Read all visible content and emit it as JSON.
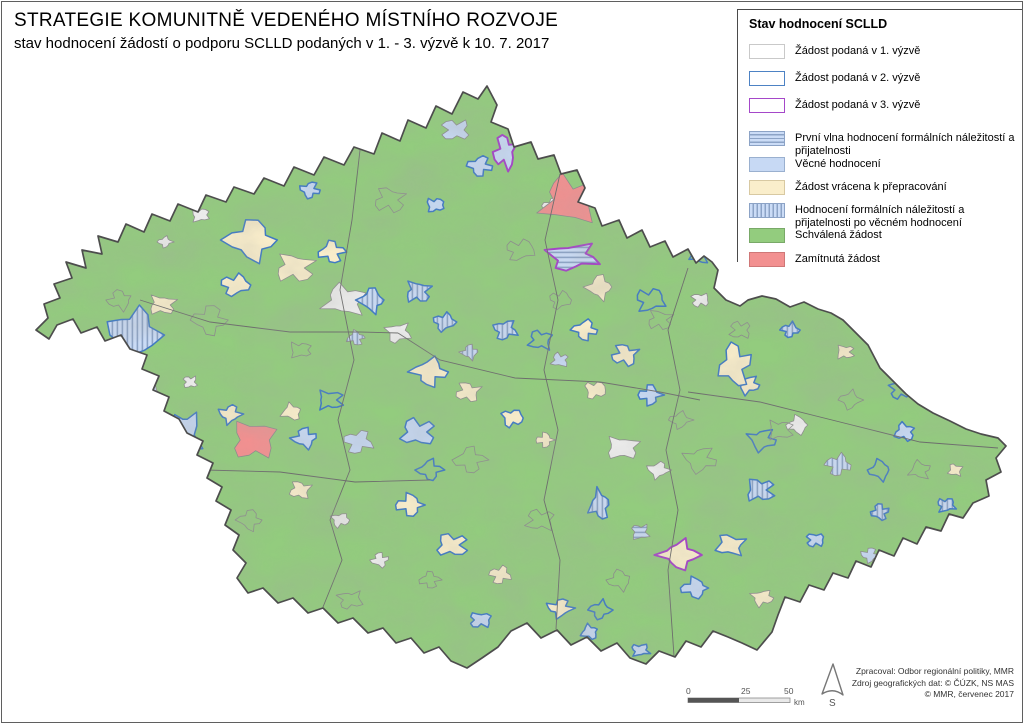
{
  "title": {
    "line1": "STRATEGIE KOMUNITNĚ VEDENÉHO MÍSTNÍHO ROZVOJE",
    "line2": "stav hodnocení žádostí o podporu SCLLD podaných v 1. - 3. výzvě k 10. 7. 2017"
  },
  "legend": {
    "title": "Stav hodnocení SCLLD",
    "items": [
      {
        "swatch": "outline-gray",
        "label": "Žádost podaná v 1. výzvě",
        "top": 34
      },
      {
        "swatch": "outline-blue",
        "label": "Žádost podaná v 2. výzvě",
        "top": 61
      },
      {
        "swatch": "outline-purple",
        "label": "Žádost podaná v 3. výzvě",
        "top": 88
      },
      {
        "swatch": "hstripe",
        "label": "První vlna hodnocení formálních náležitostí a přijatelnosti",
        "top": 121
      },
      {
        "swatch": "lightblue",
        "label": "Věcné hodnocení",
        "top": 147
      },
      {
        "swatch": "cream",
        "label": "Žádost vrácena k přepracování",
        "top": 170
      },
      {
        "swatch": "vstripe",
        "label": "Hodnocení formálních náležitostí a přijatelnosti po věcném hodnocení",
        "top": 193
      },
      {
        "swatch": "green",
        "label": "Schválená žádost",
        "top": 218
      },
      {
        "swatch": "red",
        "label": "Zamítnutá žádost",
        "top": 242
      }
    ]
  },
  "scalebar": {
    "tick0": "0",
    "tick25": "25",
    "tick50": "50",
    "unit": "km"
  },
  "north": {
    "label": "S"
  },
  "credits": {
    "line1": "Zpracoval: Odbor regionální politiky, MMR",
    "line2": "Zdroj geografických dat: © ČÚZK, NS MAS",
    "line3": "© MMR, červenec 2017"
  },
  "colors": {
    "approved_green": "#93cc7e",
    "returned_cream": "#faeecb",
    "substantive_blue": "#c7d9f4",
    "rejected_red": "#f29090",
    "no_status_white": "#f0f0f0",
    "stripe_line": "#8ca3c6",
    "stripe_bg": "#cbdcf6",
    "call2_outline": "#3e79c4",
    "call3_outline": "#a440c8",
    "country_border": "#4d4d4d",
    "region_border": "#8c8c8c",
    "kraj_border": "#6a6a6a"
  },
  "map": {
    "outline": "36,330 48,318 44,304 60,298 54,284 72,278 66,262 86,268 82,250 102,254 98,236 118,242 126,224 144,232 152,214 170,221 178,204 198,212 206,195 226,202 234,187 254,194 264,178 284,186 294,167 314,175 324,157 344,165 354,147 374,154 382,133 400,141 408,120 426,128 436,106 452,114 463,92 478,99 487,86 497,105 491,122 508,129 514,147 531,142 538,159 554,155 561,174 577,170 585,188 578,202 595,208 602,226 619,220 627,238 642,230 650,247 665,241 673,257 688,249 696,263 704,256 712,262 718,270 714,288 726,300 740,306 748,300 762,296 776,299 790,307 804,302 818,309 831,313 843,320 856,333 868,345 880,368 893,381 906,394 918,404 933,413 950,421 966,429 981,434 998,438 1006,446 996,458 1001,472 986,480 989,496 973,503 963,518 949,514 941,531 926,527 917,544 903,538 894,556 879,550 871,567 856,561 848,578 833,573 824,590 809,585 800,602 785,597 778,615 772,632 757,650 742,643 728,637 713,631 701,647 686,641 675,657 659,651 646,664 630,658 617,643 601,651 587,637 571,645 557,630 541,638 527,623 511,631 498,647 482,658 467,668 451,661 439,647 424,653 411,638 396,643 383,628 368,633 353,618 338,623 323,608 308,613 293,598 278,603 263,588 248,593 237,578 246,563 233,550 239,535 225,525 231,510 216,501 222,487 207,478 213,463 197,455 203,441 187,433 179,419 164,411 169,397 153,390 159,376 142,369 147,355 130,349 121,335 105,341 97,327 81,333 73,319 57,325 49,339",
    "kraj_lines": [
      "360,150 352,220 340,290 354,360 338,420 350,470 330,520 342,560 323,607",
      "560,174 545,240 558,300 544,370 558,430 544,500 560,560 556,629",
      "688,268 668,330 680,390 666,450 678,510 668,570 674,656",
      "140,300 210,322 290,332 360,332 398,333",
      "398,333 440,360 515,378 600,382 660,392 700,400",
      "688,392 760,402 840,422 920,442 998,448",
      "205,470 280,472 355,482 430,480"
    ],
    "regions": [
      [
        252,
        240,
        30,
        22,
        "c",
        "b",
        1
      ],
      [
        295,
        268,
        22,
        16,
        "c",
        "g",
        2
      ],
      [
        235,
        285,
        16,
        12,
        "c",
        "b",
        3
      ],
      [
        332,
        252,
        15,
        12,
        "c",
        "b",
        4
      ],
      [
        265,
        168,
        16,
        13,
        "b",
        "g",
        5
      ],
      [
        310,
        190,
        11,
        9,
        "b",
        "b",
        6
      ],
      [
        272,
        150,
        14,
        9,
        "h",
        "g",
        7
      ],
      [
        200,
        215,
        10,
        8,
        "w",
        "g",
        8
      ],
      [
        165,
        242,
        8,
        6,
        "w",
        "g",
        9
      ],
      [
        345,
        300,
        24,
        17,
        "w",
        "g",
        10
      ],
      [
        398,
        333,
        14,
        11,
        "w",
        "g",
        11
      ],
      [
        372,
        300,
        15,
        13,
        "v",
        "b",
        12
      ],
      [
        418,
        292,
        14,
        12,
        "v",
        "b",
        13
      ],
      [
        444,
        322,
        12,
        10,
        "v",
        "b",
        14
      ],
      [
        356,
        338,
        10,
        8,
        "v",
        "g",
        15
      ],
      [
        455,
        130,
        16,
        12,
        "b",
        "g",
        16
      ],
      [
        480,
        166,
        14,
        11,
        "b",
        "b",
        17
      ],
      [
        505,
        152,
        13,
        19,
        "b",
        "p",
        18
      ],
      [
        435,
        205,
        10,
        8,
        "b",
        "b",
        19
      ],
      [
        553,
        206,
        12,
        9,
        "w",
        "g",
        20
      ],
      [
        570,
        200,
        32,
        26,
        "r",
        "g",
        21
      ],
      [
        572,
        257,
        28,
        15,
        "h",
        "p",
        22
      ],
      [
        600,
        287,
        15,
        13,
        "c",
        "g",
        23
      ],
      [
        162,
        305,
        15,
        11,
        "c",
        "g",
        24
      ],
      [
        133,
        335,
        28,
        30,
        "v",
        "b",
        25
      ],
      [
        80,
        342,
        13,
        9,
        "b",
        "g",
        26
      ],
      [
        190,
        382,
        8,
        7,
        "w",
        "g",
        27
      ],
      [
        585,
        330,
        14,
        11,
        "c",
        "b",
        28
      ],
      [
        625,
        355,
        15,
        12,
        "c",
        "b",
        29
      ],
      [
        595,
        390,
        12,
        10,
        "c",
        "g",
        30
      ],
      [
        650,
        395,
        13,
        11,
        "b",
        "b",
        31
      ],
      [
        560,
        360,
        10,
        8,
        "b",
        "g",
        32
      ],
      [
        505,
        330,
        13,
        11,
        "v",
        "b",
        33
      ],
      [
        470,
        352,
        10,
        8,
        "v",
        "g",
        34
      ],
      [
        622,
        448,
        18,
        13,
        "w",
        "g",
        35
      ],
      [
        658,
        470,
        12,
        9,
        "w",
        "g",
        36
      ],
      [
        600,
        505,
        12,
        16,
        "v",
        "b",
        37
      ],
      [
        640,
        532,
        10,
        9,
        "h",
        "g",
        38
      ],
      [
        430,
        372,
        20,
        15,
        "c",
        "b",
        39
      ],
      [
        468,
        392,
        14,
        11,
        "c",
        "g",
        40
      ],
      [
        512,
        418,
        12,
        10,
        "c",
        "b",
        41
      ],
      [
        545,
        440,
        10,
        8,
        "c",
        "g",
        42
      ],
      [
        418,
        432,
        20,
        15,
        "b",
        "b",
        43
      ],
      [
        358,
        442,
        16,
        13,
        "b",
        "g",
        44
      ],
      [
        305,
        438,
        14,
        11,
        "b",
        "b",
        45
      ],
      [
        253,
        440,
        24,
        22,
        "r",
        "g",
        46
      ],
      [
        230,
        414,
        12,
        10,
        "c",
        "b",
        47
      ],
      [
        292,
        412,
        12,
        9,
        "c",
        "g",
        48
      ],
      [
        185,
        435,
        17,
        27,
        "b",
        "b",
        49
      ],
      [
        152,
        395,
        12,
        10,
        "b",
        "g",
        50
      ],
      [
        300,
        490,
        12,
        10,
        "c",
        "g",
        51
      ],
      [
        340,
        520,
        10,
        8,
        "w",
        "g",
        52
      ],
      [
        410,
        505,
        16,
        12,
        "c",
        "b",
        53
      ],
      [
        452,
        545,
        18,
        13,
        "c",
        "b",
        54
      ],
      [
        500,
        575,
        12,
        10,
        "c",
        "g",
        55
      ],
      [
        380,
        560,
        10,
        8,
        "w",
        "g",
        56
      ],
      [
        480,
        620,
        12,
        9,
        "b",
        "b",
        57
      ],
      [
        560,
        608,
        14,
        10,
        "c",
        "b",
        58
      ],
      [
        590,
        632,
        10,
        8,
        "b",
        "b",
        59
      ],
      [
        640,
        650,
        10,
        7,
        "b",
        "b",
        60
      ],
      [
        680,
        555,
        22,
        15,
        "c",
        "p",
        61
      ],
      [
        730,
        545,
        16,
        12,
        "c",
        "b",
        62
      ],
      [
        762,
        598,
        12,
        9,
        "c",
        "g",
        63
      ],
      [
        695,
        588,
        16,
        11,
        "b",
        "b",
        64
      ],
      [
        760,
        490,
        16,
        13,
        "v",
        "b",
        65
      ],
      [
        838,
        465,
        14,
        12,
        "v",
        "g",
        66
      ],
      [
        880,
        512,
        10,
        9,
        "v",
        "b",
        67
      ],
      [
        815,
        540,
        10,
        8,
        "b",
        "b",
        68
      ],
      [
        870,
        555,
        10,
        8,
        "b",
        "g",
        69
      ],
      [
        905,
        432,
        12,
        10,
        "b",
        "b",
        70
      ],
      [
        946,
        505,
        10,
        8,
        "v",
        "b",
        71
      ],
      [
        930,
        545,
        8,
        7,
        "w",
        "g",
        72
      ],
      [
        955,
        470,
        8,
        7,
        "c",
        "g",
        73
      ],
      [
        748,
        385,
        12,
        10,
        "c",
        "b",
        74
      ],
      [
        798,
        425,
        13,
        10,
        "w",
        "g",
        75
      ],
      [
        845,
        352,
        10,
        8,
        "c",
        "g",
        76
      ],
      [
        790,
        330,
        10,
        8,
        "v",
        "b",
        77
      ],
      [
        735,
        365,
        18,
        24,
        "c",
        "b",
        78
      ],
      [
        700,
        300,
        10,
        8,
        "w",
        "g",
        79
      ],
      [
        865,
        625,
        10,
        8,
        "h",
        "b",
        80
      ],
      [
        912,
        582,
        10,
        8,
        "b",
        "b",
        81
      ],
      [
        650,
        300,
        16,
        13,
        "g",
        "b",
        82
      ],
      [
        430,
        470,
        14,
        11,
        "g",
        "b",
        83
      ],
      [
        540,
        340,
        13,
        11,
        "g",
        "b",
        84
      ],
      [
        762,
        440,
        15,
        12,
        "g",
        "b",
        85
      ],
      [
        880,
        470,
        13,
        11,
        "g",
        "b",
        86
      ],
      [
        330,
        400,
        14,
        11,
        "g",
        "b",
        87
      ],
      [
        600,
        610,
        12,
        10,
        "g",
        "b",
        88
      ],
      [
        700,
        255,
        11,
        9,
        "g",
        "b",
        89
      ],
      [
        900,
        390,
        12,
        10,
        "g",
        "b",
        90
      ],
      [
        210,
        320,
        20,
        16,
        "n",
        "g",
        91
      ],
      [
        390,
        200,
        18,
        14,
        "n",
        "g",
        92
      ],
      [
        520,
        250,
        16,
        12,
        "n",
        "g",
        93
      ],
      [
        470,
        460,
        18,
        14,
        "n",
        "g",
        94
      ],
      [
        540,
        520,
        16,
        12,
        "n",
        "g",
        95
      ],
      [
        700,
        460,
        18,
        14,
        "n",
        "g",
        96
      ],
      [
        620,
        580,
        14,
        11,
        "n",
        "g",
        97
      ],
      [
        780,
        430,
        14,
        11,
        "n",
        "g",
        98
      ],
      [
        850,
        400,
        12,
        10,
        "n",
        "g",
        99
      ],
      [
        920,
        470,
        12,
        10,
        "n",
        "g",
        100
      ],
      [
        350,
        600,
        14,
        10,
        "n",
        "g",
        101
      ],
      [
        250,
        520,
        14,
        11,
        "n",
        "g",
        102
      ],
      [
        660,
        320,
        14,
        11,
        "n",
        "g",
        103
      ],
      [
        560,
        300,
        12,
        10,
        "n",
        "g",
        104
      ],
      [
        430,
        580,
        12,
        9,
        "n",
        "g",
        105
      ],
      [
        740,
        330,
        12,
        10,
        "n",
        "g",
        106
      ],
      [
        890,
        580,
        12,
        9,
        "n",
        "g",
        107
      ],
      [
        120,
        300,
        14,
        11,
        "n",
        "g",
        108
      ],
      [
        300,
        350,
        12,
        9,
        "n",
        "g",
        109
      ],
      [
        680,
        420,
        12,
        9,
        "n",
        "g",
        110
      ]
    ]
  }
}
